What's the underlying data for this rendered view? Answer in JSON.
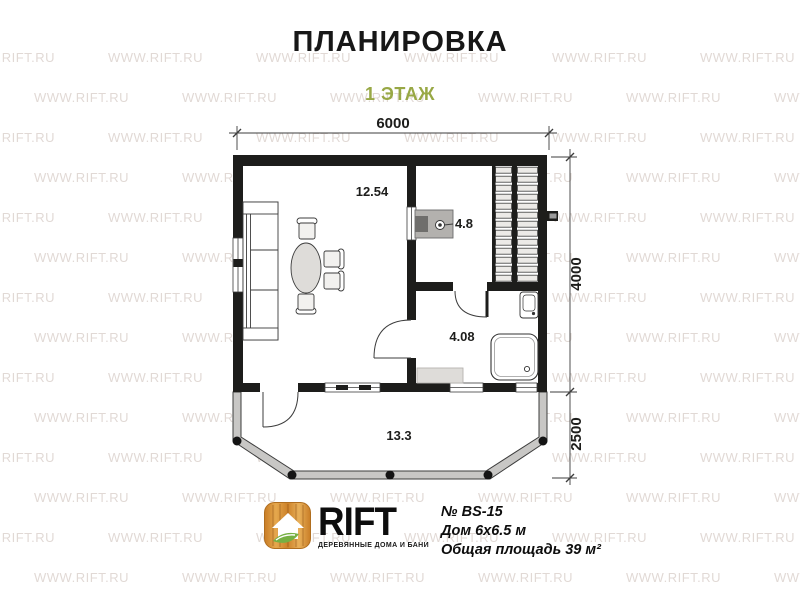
{
  "header": {
    "title": "ПЛАНИРОВКА",
    "subtitle": "1 ЭТАЖ"
  },
  "plan": {
    "dimensions": {
      "top_width": "6000",
      "right_height": "4000",
      "veranda_height": "2500"
    },
    "rooms": {
      "living_area": "12.54",
      "kitchen_area": "4.8",
      "bathroom_area": "4.08",
      "veranda_area": "13.3"
    }
  },
  "brand": {
    "name": "RIFT",
    "tagline": "ДЕРЕВЯННЫЕ ДОМА И БАНИ"
  },
  "project": {
    "number": "№ BS-15",
    "house_size": "Дом 6х6.5 м",
    "total_area": "Общая площадь 39 м²"
  },
  "watermark": {
    "text": "WWW.RIFT.RU"
  },
  "colors": {
    "accent_green": "#98a845",
    "wall_black": "#1d1d1b",
    "wood_orange": "#d78d33",
    "leaf_green": "#76b043"
  }
}
